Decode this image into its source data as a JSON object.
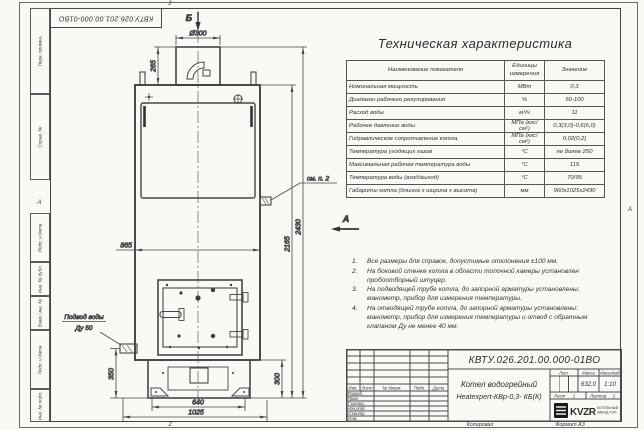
{
  "frame": {
    "corner_docnum": "КВТУ.026.201.00.000-01ВО",
    "margin_boxes": [
      "Перв. примен.",
      "Справ. №",
      "Подп. и дата",
      "Инв. № дубл.",
      "Взам. инв. №",
      "Подп. и дата",
      "Инв. № подл."
    ],
    "zones": {
      "top": "2",
      "bottom": "2",
      "left": "А",
      "right": "А"
    }
  },
  "drawing": {
    "view_b": "Б",
    "view_a": "А",
    "dims": {
      "chimney_d": "Ø300",
      "chimney_h": "265",
      "body_w": "865",
      "total_h": "2430",
      "body_h": "2165",
      "base_h_left": "350",
      "base_h_right": "300",
      "base_w": "640",
      "footprint_w": "1025"
    },
    "callouts": {
      "see_note": "см. п. 2",
      "water_inlet_1": "Подвод воды",
      "water_inlet_2": "Ду 50"
    }
  },
  "spec_table": {
    "title": "Техническая характеристика",
    "headers": [
      "Наименование показателя",
      "Единицы измерения",
      "Значение"
    ],
    "rows": [
      {
        "name": "Номинальная мощность",
        "unit": "МВт",
        "value": "0,3"
      },
      {
        "name": "Диапазон рабочего регулирования",
        "unit": "%",
        "value": "50-100"
      },
      {
        "name": "Расход воды",
        "unit": "м³/ч",
        "value": "11"
      },
      {
        "name": "Рабочее давление воды",
        "unit": "МПа (кгс/см²)",
        "value": "0,3(3,0)-0,6(6,0)"
      },
      {
        "name": "Гидравлическое сопротивление котла",
        "unit": "МПа (кгс/см²)",
        "value": "0,02(0,2)"
      },
      {
        "name": "Температура уходящих газов",
        "unit": "°С",
        "value": "не более 250"
      },
      {
        "name": "Максимальная рабочая температура воды",
        "unit": "°С",
        "value": "115"
      },
      {
        "name": "Температура воды (вход/выход)",
        "unit": "°С",
        "value": "70/95"
      },
      {
        "name": "Габариты котла (длинна х ширина х высота)",
        "unit": "мм",
        "value": "960х1025х2430"
      }
    ]
  },
  "notes": {
    "items": [
      {
        "num": "1.",
        "text": "Все размеры для справок, допустимые отклонения ±100 мм."
      },
      {
        "num": "2.",
        "text": "На боковой стенке котла в области топочной камеры установлен пробоотборный штуцер."
      },
      {
        "num": "3.",
        "text": "На подводящей трубе котла, до запорной арматуры установлены: манометр, прибор для измерения температуры."
      },
      {
        "num": "4.",
        "text": "На отводящей трубе котла, до запорной арматуры установлены: манометр, прибор для измерения температуры и отвод с обратным клапаном Ду не менее 40 мм."
      }
    ]
  },
  "title_block": {
    "doc_number": "КВТУ.026.201.00.000-01ВО",
    "name_line1": "Котел водогрейный",
    "name_line2": "Heatexpert-КВр-0,3- КБ(К)",
    "rev_headers": [
      "Изм.",
      "Лист",
      "№ докум.",
      "Подп.",
      "Дата"
    ],
    "roles": [
      "Разраб.",
      "Пров.",
      "Т.контр.",
      "Нач.отд.",
      "Н.контр.",
      "Утв."
    ],
    "lit_label": "Лит.",
    "mass_label": "Масса",
    "scale_label": "Масштаб",
    "mass": "632,0",
    "scale": "1:10",
    "sheet_label": "Лист",
    "sheet_num": "1",
    "sheets_label": "Листов",
    "sheets_num": "2",
    "logo_text": "KVZR",
    "logo_sub1": "КОТЕЛЬНЫЙ",
    "logo_sub2": "ЗАВОД РЭП",
    "footer_copy": "Копировал",
    "footer_format": "Формат А3"
  },
  "colors": {
    "ink": "#474747",
    "ink_dark": "#333333",
    "logo_black": "#1a1a1a"
  }
}
